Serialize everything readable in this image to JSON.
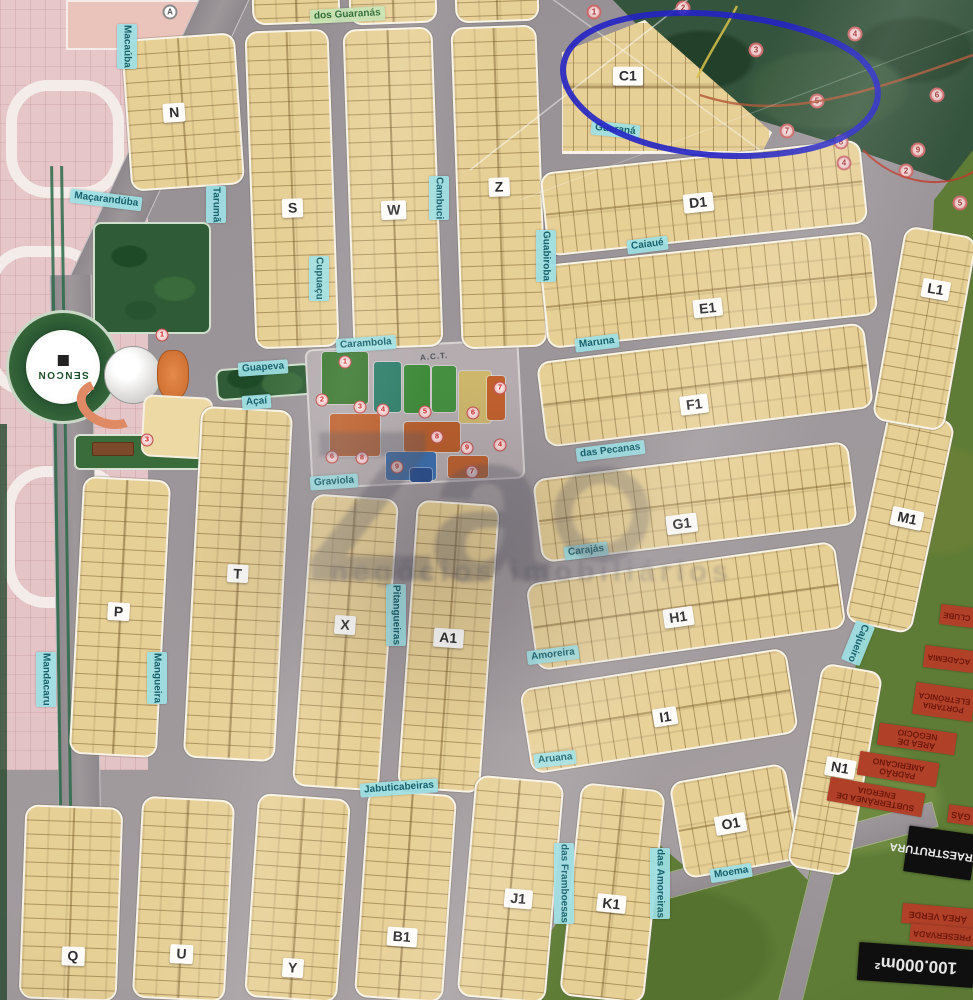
{
  "watermark": {
    "brand": "Za",
    "tagline": "negócios imobiliários"
  },
  "logo": {
    "name": "SENCON"
  },
  "amenities": {
    "title": "A.C.T."
  },
  "highlight": {
    "block": "C1",
    "color": "#2423c4"
  },
  "blocks": [
    {
      "label": "N",
      "x": 126,
      "y": 36,
      "w": 114,
      "h": 152,
      "r": -4,
      "dir": "v",
      "lx": 0.42,
      "ly": 0.5
    },
    {
      "label": "S",
      "x": 250,
      "y": 30,
      "w": 84,
      "h": 318,
      "r": -2,
      "dir": "v",
      "lx": 0.5,
      "ly": 0.56
    },
    {
      "label": "W",
      "x": 348,
      "y": 28,
      "w": 90,
      "h": 320,
      "r": -2,
      "dir": "v",
      "lx": 0.5,
      "ly": 0.57
    },
    {
      "label": "Z",
      "x": 456,
      "y": 26,
      "w": 86,
      "h": 322,
      "r": -2,
      "dir": "v",
      "lx": 0.5,
      "ly": 0.5
    },
    {
      "label": "C1",
      "x": 560,
      "y": 20,
      "w": 212,
      "h": 134,
      "r": 0,
      "dir": "h",
      "shape": "tri",
      "lx": 0.32,
      "ly": 0.42
    },
    {
      "label": "D1",
      "x": 543,
      "y": 156,
      "w": 322,
      "h": 84,
      "r": -6,
      "dir": "h",
      "lx": 0.48,
      "ly": 0.55
    },
    {
      "label": "E1",
      "x": 543,
      "y": 248,
      "w": 332,
      "h": 84,
      "r": -6,
      "dir": "h",
      "lx": 0.49,
      "ly": 0.72
    },
    {
      "label": "F1",
      "x": 540,
      "y": 342,
      "w": 330,
      "h": 86,
      "r": -7,
      "dir": "h",
      "lx": 0.46,
      "ly": 0.72
    },
    {
      "label": "G1",
      "x": 536,
      "y": 460,
      "w": 318,
      "h": 84,
      "r": -7,
      "dir": "h",
      "lx": 0.45,
      "ly": 0.75
    },
    {
      "label": "H1",
      "x": 530,
      "y": 562,
      "w": 312,
      "h": 88,
      "r": -8,
      "dir": "h",
      "lx": 0.47,
      "ly": 0.62
    },
    {
      "label": "I1",
      "x": 524,
      "y": 668,
      "w": 270,
      "h": 86,
      "r": -9,
      "dir": "h",
      "lx": 0.52,
      "ly": 0.58
    },
    {
      "label": "P",
      "x": 76,
      "y": 478,
      "w": 88,
      "h": 278,
      "r": 3,
      "dir": "v",
      "lx": 0.48,
      "ly": 0.48
    },
    {
      "label": "T",
      "x": 192,
      "y": 408,
      "w": 92,
      "h": 352,
      "r": 3,
      "dir": "v",
      "lx": 0.49,
      "ly": 0.47
    },
    {
      "label": "X",
      "x": 302,
      "y": 496,
      "w": 87,
      "h": 293,
      "r": 4,
      "dir": "v",
      "lx": 0.48,
      "ly": 0.44
    },
    {
      "label": "A1",
      "x": 407,
      "y": 502,
      "w": 83,
      "h": 289,
      "r": 4,
      "dir": "v",
      "lx": 0.49,
      "ly": 0.47
    },
    {
      "label": "Q",
      "x": 22,
      "y": 806,
      "w": 98,
      "h": 194,
      "r": 2,
      "dir": "v",
      "lx": 0.54,
      "ly": 0.78
    },
    {
      "label": "U",
      "x": 137,
      "y": 798,
      "w": 93,
      "h": 202,
      "r": 3,
      "dir": "v",
      "lx": 0.51,
      "ly": 0.78
    },
    {
      "label": "Y",
      "x": 251,
      "y": 796,
      "w": 93,
      "h": 204,
      "r": 4,
      "dir": "v",
      "lx": 0.5,
      "ly": 0.85
    },
    {
      "label": "B1",
      "x": 361,
      "y": 792,
      "w": 89,
      "h": 208,
      "r": 4,
      "dir": "v",
      "lx": 0.49,
      "ly": 0.7
    },
    {
      "label": "J1",
      "x": 466,
      "y": 778,
      "w": 89,
      "h": 222,
      "r": 5,
      "dir": "v",
      "lx": 0.6,
      "ly": 0.54
    },
    {
      "label": "K1",
      "x": 570,
      "y": 786,
      "w": 85,
      "h": 214,
      "r": 6,
      "dir": "v",
      "lx": 0.5,
      "ly": 0.55
    },
    {
      "label": "O1",
      "x": 676,
      "y": 772,
      "w": 118,
      "h": 98,
      "r": -10,
      "dir": "h",
      "lx": 0.46,
      "ly": 0.52
    },
    {
      "label": "N1",
      "x": 804,
      "y": 666,
      "w": 62,
      "h": 207,
      "r": 10,
      "dir": "v",
      "lx": 0.58,
      "ly": 0.49
    },
    {
      "label": "M1",
      "x": 866,
      "y": 413,
      "w": 68,
      "h": 217,
      "r": 12,
      "dir": "v",
      "lx": 0.6,
      "ly": 0.48
    },
    {
      "label": "L1",
      "x": 888,
      "y": 230,
      "w": 73,
      "h": 197,
      "r": 10,
      "dir": "v",
      "lx": 0.56,
      "ly": 0.29
    },
    {
      "label": "",
      "x": 252,
      "y": -12,
      "w": 88,
      "h": 36,
      "r": -2,
      "dir": "v"
    },
    {
      "label": "",
      "x": 349,
      "y": -12,
      "w": 88,
      "h": 36,
      "r": -2,
      "dir": "v"
    },
    {
      "label": "",
      "x": 455,
      "y": -14,
      "w": 84,
      "h": 36,
      "r": -2,
      "dir": "v"
    }
  ],
  "streets": [
    {
      "label": "dos Guaranás",
      "x": 310,
      "y": 8,
      "r": -3,
      "green": true
    },
    {
      "label": "Macaúba",
      "x": 117,
      "y": 24,
      "v": true
    },
    {
      "label": "Maçarandúba",
      "x": 70,
      "y": 193,
      "r": 7
    },
    {
      "label": "Tarumã",
      "x": 206,
      "y": 186,
      "v": true
    },
    {
      "label": "Cupuaçu",
      "x": 309,
      "y": 256,
      "v": true
    },
    {
      "label": "Cambuci",
      "x": 429,
      "y": 176,
      "v": true
    },
    {
      "label": "Guabiroba",
      "x": 536,
      "y": 230,
      "v": true
    },
    {
      "label": "Guaraná",
      "x": 591,
      "y": 123,
      "r": 6
    },
    {
      "label": "Caiaué",
      "x": 627,
      "y": 238,
      "r": -7
    },
    {
      "label": "Maruna",
      "x": 575,
      "y": 336,
      "r": -7
    },
    {
      "label": "das Pecanas",
      "x": 576,
      "y": 444,
      "r": -7
    },
    {
      "label": "Carajás",
      "x": 564,
      "y": 544,
      "r": -7
    },
    {
      "label": "Amoreira",
      "x": 527,
      "y": 648,
      "r": -7
    },
    {
      "label": "Aruana",
      "x": 534,
      "y": 752,
      "r": -6
    },
    {
      "label": "Jabuticabeiras",
      "x": 360,
      "y": 781,
      "r": -4
    },
    {
      "label": "Mandacaru",
      "x": 36,
      "y": 652,
      "v": true
    },
    {
      "label": "Mangueira",
      "x": 147,
      "y": 652,
      "v": true
    },
    {
      "label": "Pitangueiras",
      "x": 386,
      "y": 584,
      "v": true
    },
    {
      "label": "das Framboesas",
      "x": 554,
      "y": 843,
      "v": true
    },
    {
      "label": "das Amoreiras",
      "x": 650,
      "y": 848,
      "v": true
    },
    {
      "label": "Moema",
      "x": 710,
      "y": 866,
      "r": -9
    },
    {
      "label": "Cajueiro",
      "x": 848,
      "y": 622,
      "v": true,
      "r": 22
    },
    {
      "label": "Guapeva",
      "x": 238,
      "y": 361,
      "r": -4
    },
    {
      "label": "Açaí",
      "x": 242,
      "y": 395,
      "r": -4
    },
    {
      "label": "Graviola",
      "x": 310,
      "y": 475,
      "r": -4
    },
    {
      "label": "Carambola",
      "x": 336,
      "y": 337,
      "r": -4
    }
  ],
  "forest_markers": [
    {
      "x": 594,
      "y": 12,
      "n": "1"
    },
    {
      "x": 683,
      "y": 8,
      "n": "2"
    },
    {
      "x": 756,
      "y": 50,
      "n": "3"
    },
    {
      "x": 855,
      "y": 34,
      "n": "4"
    },
    {
      "x": 817,
      "y": 101,
      "n": "5"
    },
    {
      "x": 937,
      "y": 95,
      "n": "6"
    },
    {
      "x": 787,
      "y": 131,
      "n": "7"
    },
    {
      "x": 841,
      "y": 142,
      "n": "8"
    },
    {
      "x": 918,
      "y": 150,
      "n": "9"
    },
    {
      "x": 906,
      "y": 171,
      "n": "2"
    },
    {
      "x": 844,
      "y": 163,
      "n": "4"
    },
    {
      "x": 960,
      "y": 203,
      "n": "5"
    }
  ],
  "amenity_badges": [
    {
      "x": 345,
      "y": 362,
      "n": "1"
    },
    {
      "x": 322,
      "y": 400,
      "n": "2"
    },
    {
      "x": 360,
      "y": 407,
      "n": "3"
    },
    {
      "x": 383,
      "y": 410,
      "n": "4"
    },
    {
      "x": 425,
      "y": 412,
      "n": "5"
    },
    {
      "x": 473,
      "y": 413,
      "n": "6"
    },
    {
      "x": 500,
      "y": 388,
      "n": "7"
    },
    {
      "x": 437,
      "y": 437,
      "n": "8"
    },
    {
      "x": 467,
      "y": 448,
      "n": "9"
    },
    {
      "x": 500,
      "y": 445,
      "n": "4"
    },
    {
      "x": 332,
      "y": 457,
      "n": "6"
    },
    {
      "x": 362,
      "y": 458,
      "n": "8"
    },
    {
      "x": 397,
      "y": 467,
      "n": "9"
    },
    {
      "x": 472,
      "y": 472,
      "n": "7"
    },
    {
      "x": 162,
      "y": 335,
      "n": "1"
    },
    {
      "x": 147,
      "y": 440,
      "n": "3"
    }
  ],
  "amenity_tiles": [
    {
      "x": 322,
      "y": 352,
      "w": 46,
      "h": 52,
      "c": "#3e7a33"
    },
    {
      "x": 374,
      "y": 362,
      "w": 27,
      "h": 50,
      "c": "#2f7f6b"
    },
    {
      "x": 404,
      "y": 365,
      "w": 26,
      "h": 48,
      "c": "#3d8a38"
    },
    {
      "x": 432,
      "y": 366,
      "w": 24,
      "h": 46,
      "c": "#449040"
    },
    {
      "x": 459,
      "y": 371,
      "w": 32,
      "h": 52,
      "c": "#cdb76d"
    },
    {
      "x": 330,
      "y": 414,
      "w": 50,
      "h": 42,
      "c": "#c2632f"
    },
    {
      "x": 404,
      "y": 422,
      "w": 56,
      "h": 30,
      "c": "#b95e2c"
    },
    {
      "x": 487,
      "y": 376,
      "w": 18,
      "h": 44,
      "c": "#c0602e"
    },
    {
      "x": 386,
      "y": 452,
      "w": 50,
      "h": 28,
      "c": "#3a6fae"
    },
    {
      "x": 448,
      "y": 456,
      "w": 40,
      "h": 22,
      "c": "#bd6130"
    },
    {
      "x": 410,
      "y": 468,
      "w": 22,
      "h": 14,
      "c": "#2a4f8f"
    }
  ],
  "legend": [
    {
      "t": "CLUBE",
      "x": 940,
      "y": 606,
      "w": 34,
      "h": 20,
      "r": 187,
      "k": "red",
      "fs": 8
    },
    {
      "t": "ACADEMIA",
      "x": 924,
      "y": 648,
      "w": 50,
      "h": 22,
      "r": 187,
      "k": "red",
      "fs": 8
    },
    {
      "t": "PORTARIA ELETRÔNICA",
      "x": 914,
      "y": 686,
      "w": 60,
      "h": 32,
      "r": 188,
      "k": "red",
      "fs": 8
    },
    {
      "t": "ÁREA DE NEGÓCIO",
      "x": 878,
      "y": 728,
      "w": 78,
      "h": 22,
      "r": 188,
      "k": "red",
      "fs": 8.5
    },
    {
      "t": "PADRÃO AMERICANO",
      "x": 858,
      "y": 757,
      "w": 80,
      "h": 24,
      "r": 189,
      "k": "red",
      "fs": 8.5
    },
    {
      "t": "SUBTERRÂNEA DE ENERGIA",
      "x": 828,
      "y": 785,
      "w": 96,
      "h": 24,
      "r": 190,
      "k": "red",
      "fs": 8.5
    },
    {
      "t": "GÁS",
      "x": 948,
      "y": 806,
      "w": 26,
      "h": 18,
      "r": 188,
      "k": "red",
      "fs": 9
    },
    {
      "t": "INFRAESTRUTURA",
      "x": 906,
      "y": 830,
      "w": 68,
      "h": 46,
      "r": 188,
      "k": "black",
      "fs": 11
    },
    {
      "t": "ÁREA VERDE",
      "x": 902,
      "y": 906,
      "w": 72,
      "h": 20,
      "r": 185,
      "k": "red",
      "fs": 9
    },
    {
      "t": "PRESERVADA",
      "x": 910,
      "y": 926,
      "w": 64,
      "h": 18,
      "r": 185,
      "k": "red",
      "fs": 8.5
    },
    {
      "t": "100.000m²",
      "x": 858,
      "y": 946,
      "w": 116,
      "h": 38,
      "r": 184,
      "k": "black",
      "fs": 17
    }
  ]
}
